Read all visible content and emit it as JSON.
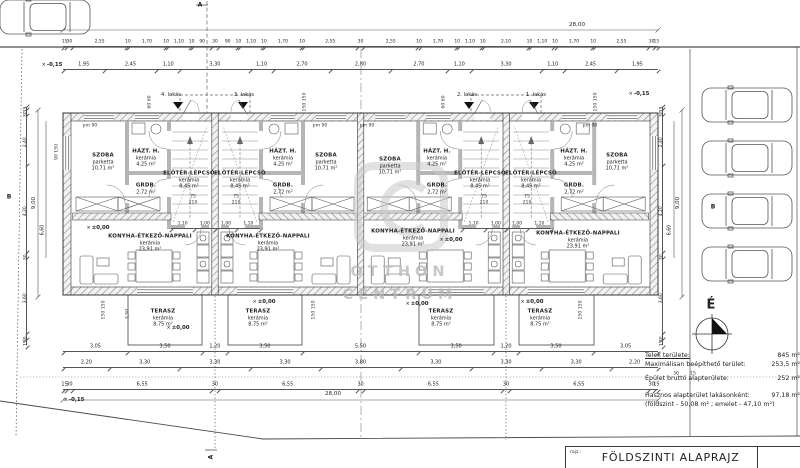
{
  "sheet": {
    "drawing_label": "rajz :",
    "drawing_title": "FÖLDSZINTI ALAPRAJZ"
  },
  "info": {
    "l1": "Telek területe:",
    "v1": "845 m²",
    "l2": "Maximálisan beépíthető terület:",
    "v2": "253,5 m²",
    "l3": "Épület bruttó alapterülete:",
    "v3": "252 m²",
    "l4": "Hasznos alapterület lakásonként:",
    "v4": "97,18 m²",
    "l5": "(földszint - 50,08 m² ; emelet - 47,10 m²)"
  },
  "compass": {
    "north": "É"
  },
  "watermark": {
    "line1": "OTTHON",
    "line2": "CENTRUM"
  },
  "units": [
    {
      "label": "4. lakás"
    },
    {
      "label": "3. lakás"
    },
    {
      "label": "2. lakás"
    },
    {
      "label": "1. lakás"
    }
  ],
  "rooms": {
    "szoba": {
      "name": "SZOBA",
      "material": "parketta",
      "area": "10,71 m²"
    },
    "hazt": {
      "name": "HÁZT. H.",
      "material": "kerámia",
      "area": "4,25 m²"
    },
    "grdb": {
      "name": "GRDB.",
      "material": "kerámia",
      "area": "2,72 m²"
    },
    "eloter": {
      "name": "ELŐTÉR-LÉPCSŐ",
      "material": "kerámia",
      "area": "8,45 m²"
    },
    "konyha": {
      "name": "KONYHA-ÉTKEZŐ-NAPPALI",
      "material": "kerámia",
      "area": "23,91 m²"
    },
    "terasz": {
      "name": "TERASZ",
      "material": "kerámia",
      "area": "8,75 m²"
    }
  },
  "levels": {
    "zero": "±0,00",
    "minus015": "-0,15"
  },
  "dims": {
    "top_total": "28,00",
    "bottom_total": "28,00",
    "side_total": "9,00",
    "side_sub": "6,60",
    "terrace_depth": "2,50",
    "top_fine": [
      "15",
      "30",
      "2,55",
      "10",
      "1,70",
      "10",
      "1,10",
      "10",
      "90",
      "30",
      "90",
      "10",
      "1,10",
      "10",
      "1,70",
      "10",
      "2,55",
      "30",
      "2,55",
      "10",
      "1,70",
      "10",
      "1,10",
      "10",
      "2,10",
      "10",
      "1,10",
      "10",
      "1,70",
      "10",
      "2,55",
      "30",
      "15"
    ],
    "top_main": [
      "1,95",
      "2,45",
      "1,10",
      "3,30",
      "1,10",
      "2,70",
      "2,80",
      "2,70",
      "1,10",
      "3,30",
      "1,10",
      "2,45",
      "1,95"
    ],
    "terrace_row": [
      "3,05",
      "3,50",
      "1,20",
      "3,50",
      "5,50",
      "3,50",
      "1,20",
      "3,50",
      "3,05"
    ],
    "bottom_mid": [
      "2,20",
      "3,30",
      "3,30",
      "3,30",
      "3,80",
      "3,30",
      "3,30",
      "3,30",
      "2,20"
    ],
    "bottom_fine": [
      "15",
      "30",
      "6,55",
      "30",
      "6,55",
      "30",
      "6,55",
      "30",
      "6,55",
      "30",
      "15"
    ],
    "side_chain": [
      "15",
      "30",
      "2,40",
      "4,20",
      "30",
      "3,60",
      "30",
      "15"
    ],
    "core_row": [
      "1,10",
      "1,00",
      "1,00",
      "1,10"
    ]
  },
  "ann": {
    "pm90": "pm 90",
    "d75": "75",
    "d210": "210",
    "w6060": "60  60",
    "w150150": "150  150",
    "w90150": "90  150",
    "d30": "30",
    "d15": "15",
    "secA": "A",
    "secB": "B"
  }
}
